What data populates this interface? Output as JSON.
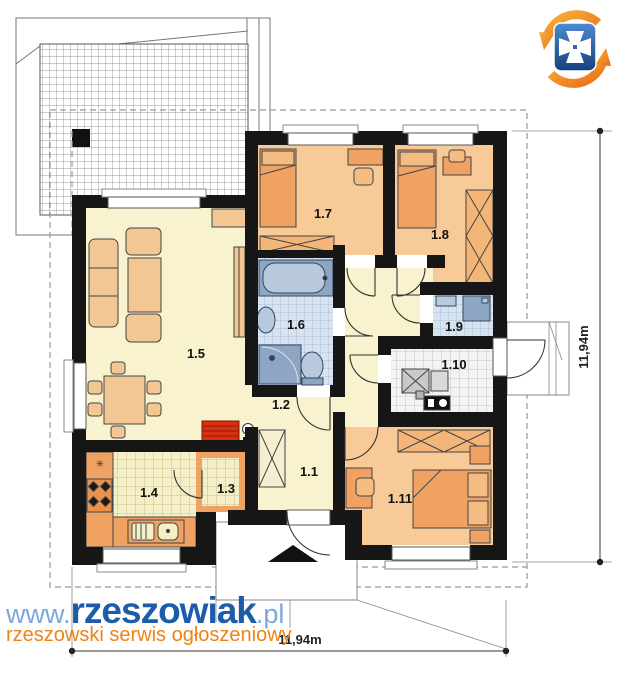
{
  "watermark": {
    "www": "www.",
    "brand": "rzeszowiak",
    "tld": ".pl",
    "tagline": "rzeszowski serwis ogłoszeniowy"
  },
  "dimensions": {
    "right": "11,94m",
    "bottom": "11,94m"
  },
  "rooms": {
    "r1_1": {
      "label": "1.1"
    },
    "r1_2": {
      "label": "1.2"
    },
    "r1_3": {
      "label": "1.3"
    },
    "r1_4": {
      "label": "1.4"
    },
    "r1_5": {
      "label": "1.5"
    },
    "r1_6": {
      "label": "1.6"
    },
    "r1_7": {
      "label": "1.7"
    },
    "r1_8": {
      "label": "1.8"
    },
    "r1_9": {
      "label": "1.9"
    },
    "r1_10": {
      "label": "1.10"
    },
    "r1_11": {
      "label": "1.11"
    }
  },
  "symbols": {
    "fridge_star": "✳"
  },
  "colors": {
    "wall": "#161616",
    "floor_cream": "#F8F2CF",
    "floor_orange": "#F7CA97",
    "furniture_orange": "#F0A263",
    "bath_tile": "#D8E3F0",
    "bath_fixture": "#8FA5C4",
    "fireplace_red": "#D93010",
    "brand_blue": "#1C5CA8",
    "brand_light_blue": "#7FA7DB",
    "brand_orange": "#F08214"
  }
}
